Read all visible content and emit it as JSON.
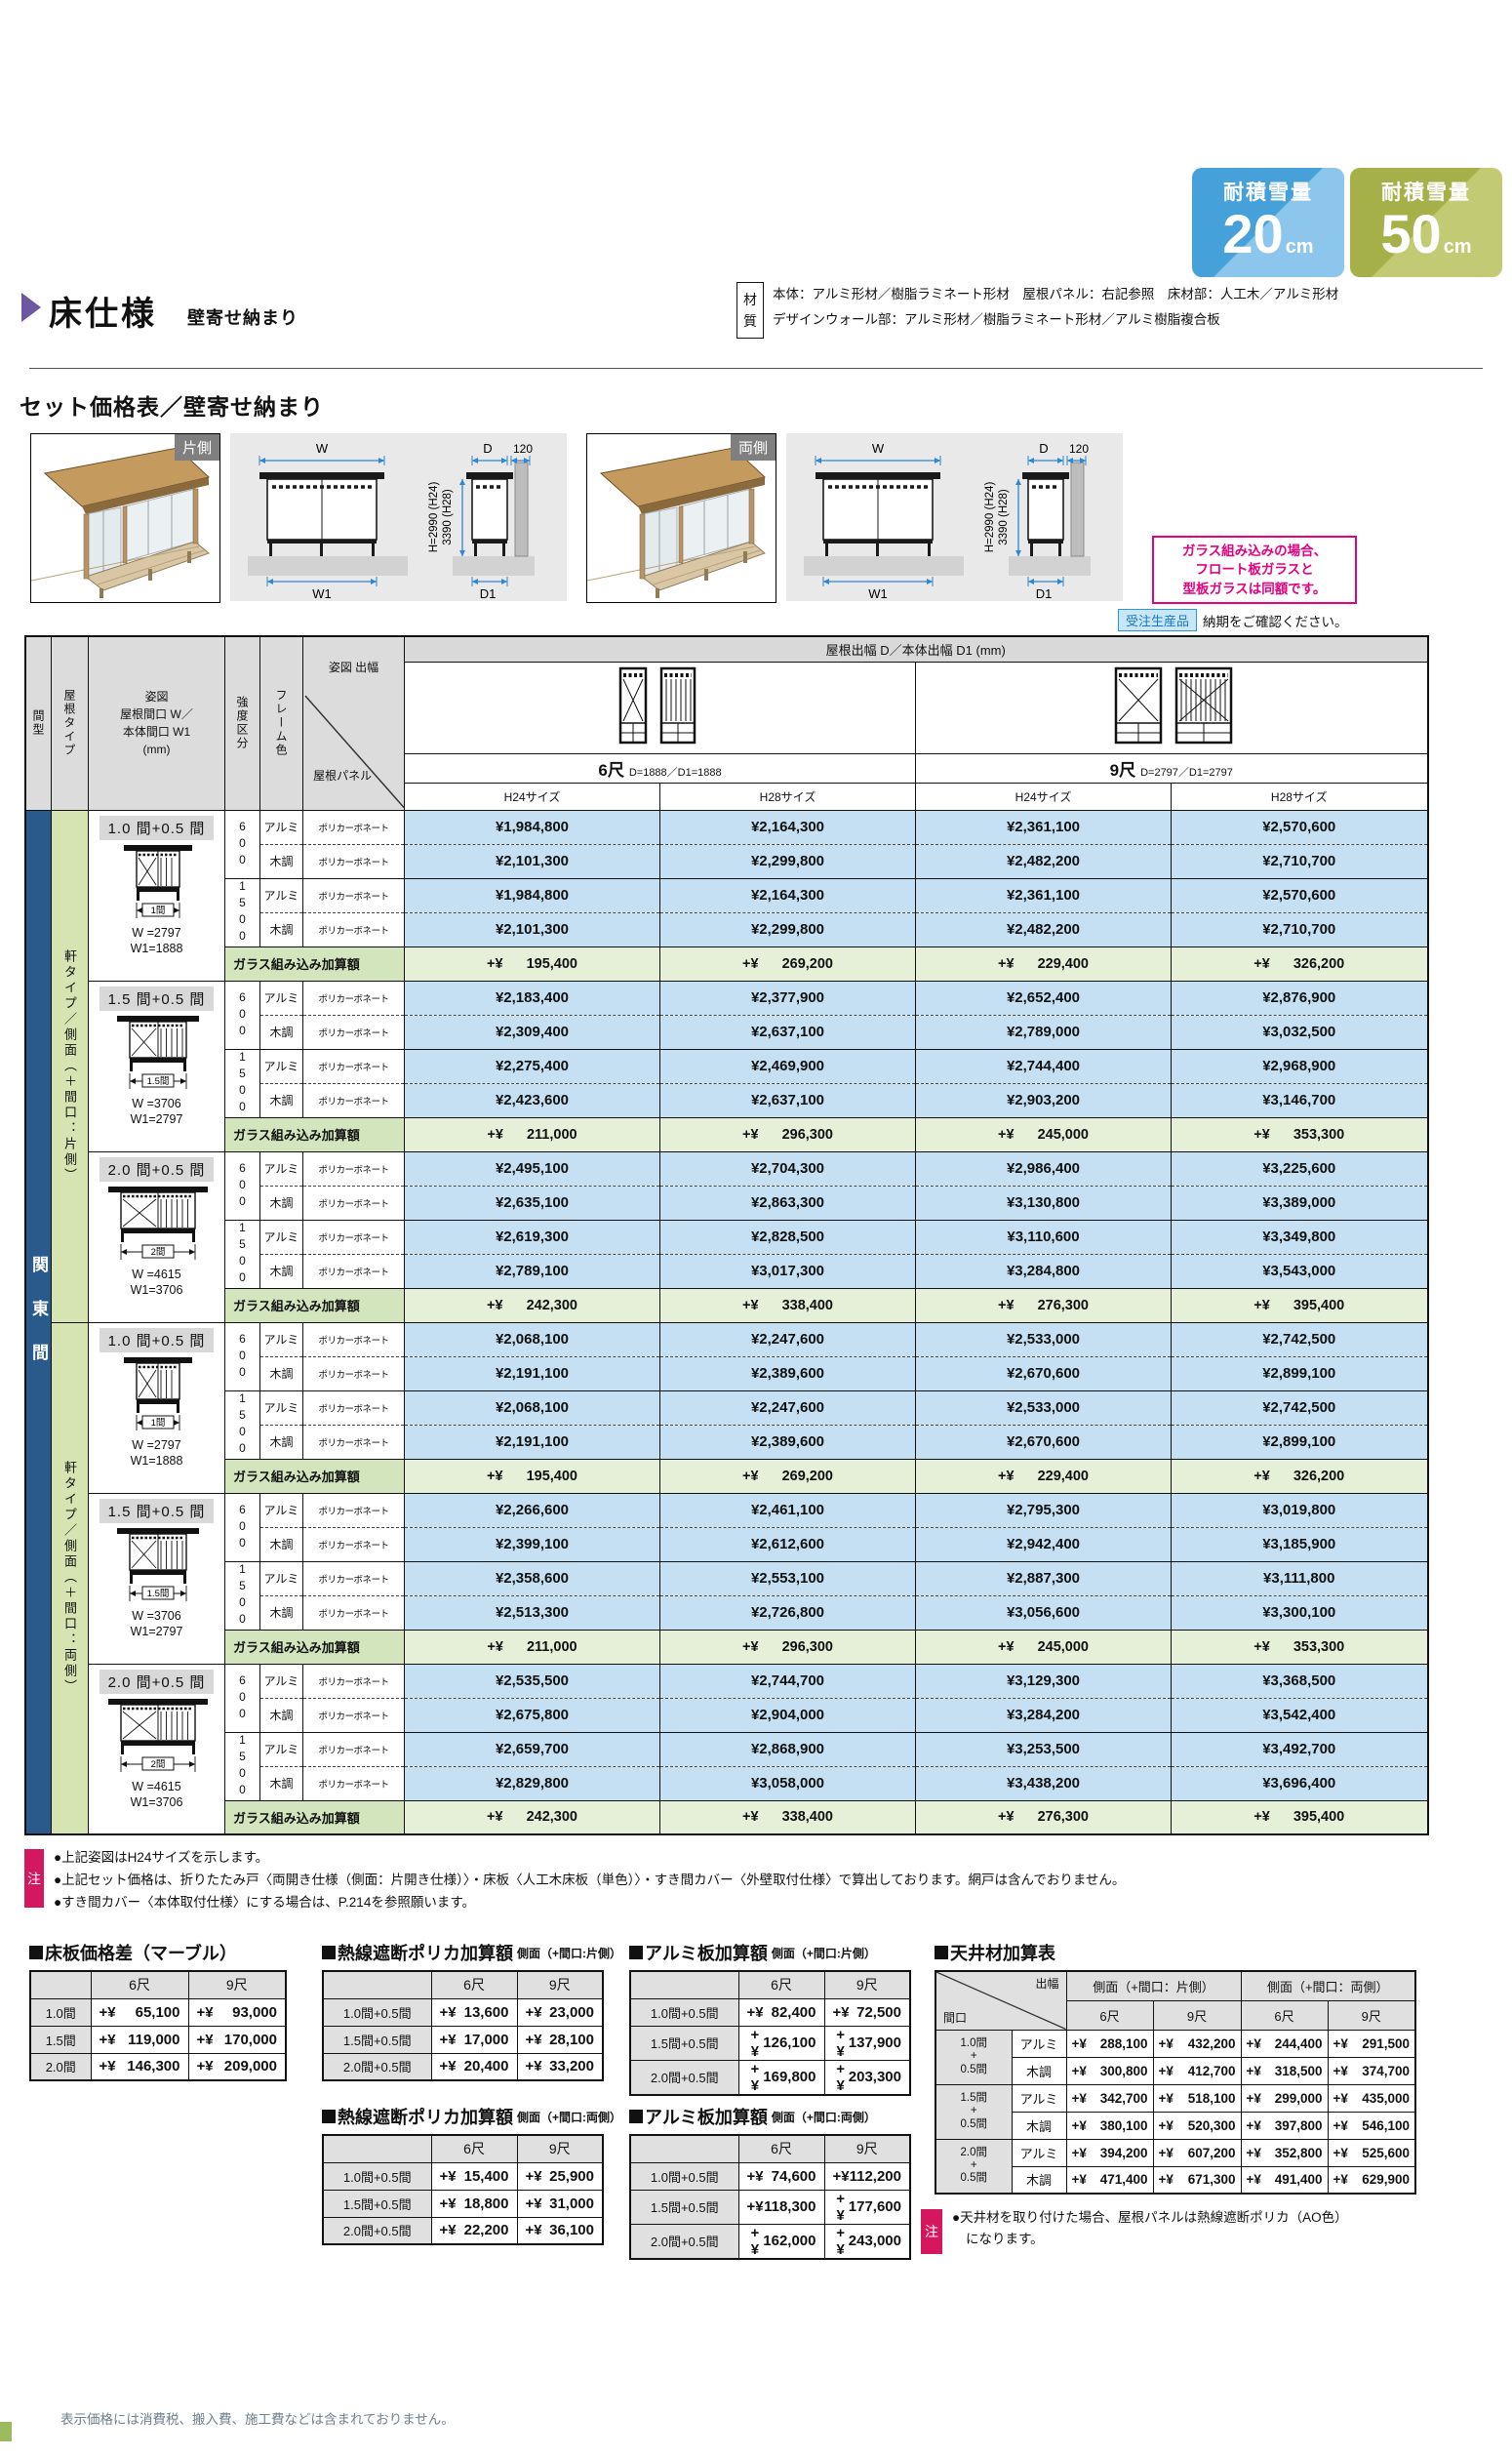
{
  "colors": {
    "pink": "#e4007f",
    "navy": "#2a598c",
    "green": "#d5e4b0",
    "blue": "#c4e0f2",
    "glass_label": "#d3e5bd",
    "glass_value": "#e6f0d9",
    "red": "#d4175e",
    "order_bg": "#c7e6f7",
    "order_border": "#2f96d3",
    "order_text": "#1878bc",
    "purple": "#6c57a0"
  },
  "badges": [
    {
      "label": "耐積雪量",
      "value": "20",
      "unit": "cm",
      "c1": "#46a0da",
      "c2": "#8cc6ec"
    },
    {
      "label": "耐積雪量",
      "value": "50",
      "unit": "cm",
      "c1": "#a6b049",
      "c2": "#c2ca73"
    }
  ],
  "header": {
    "title": "床仕様",
    "subtitle": "壁寄せ納まり",
    "material_chars": [
      "材",
      "質"
    ],
    "material_lines": [
      "本体：アルミ形材／樹脂ラミネート形材　屋根パネル：右記参照　床材部：人工木／アルミ形材",
      "デザインウォール部：アルミ形材／樹脂ラミネート形材／アルミ樹脂複合板"
    ]
  },
  "section": {
    "title": "セット価格表／壁寄せ納まり",
    "photos": [
      {
        "label": "片側"
      },
      {
        "label": "両側"
      }
    ],
    "tech": {
      "w": "W",
      "w1": "W1",
      "d": "D",
      "gap": "120",
      "d1": "D1",
      "h1": "H=2990 (H24)",
      "h2": "3390 (H28)"
    },
    "pink_note": [
      "ガラス組み込みの場合、",
      "フロート板ガラスと",
      "型板ガラスは同額です。"
    ],
    "order": {
      "badge": "受注生産品",
      "text": "納期をご確認ください。"
    }
  },
  "plus_prefix": "+¥",
  "main_table": {
    "kanto": "関東間",
    "panel_label": "ポリカーボネート",
    "glass_label": "ガラス組み込み加算額",
    "col_h": {
      "madori": "間型",
      "roof": "屋根タイプ",
      "sugata": [
        "姿図",
        "屋根間口 W／",
        "本体間口 W1",
        "(mm)"
      ],
      "kyodo": "強度区分",
      "frame": "フレーム色",
      "debuta": "姿図 出幅",
      "panel": "屋根パネル",
      "span": "屋根出幅 D／本体出幅 D1 (mm)",
      "h24": "H24サイズ",
      "h28": "H28サイズ"
    },
    "sizes": [
      {
        "feet": "6尺",
        "note": "D=1888／D1=1888"
      },
      {
        "feet": "9尺",
        "note": "D=2797／D1=2797"
      }
    ],
    "groups": [
      {
        "side_label": "軒タイプ／側面（＋間口：片側）",
        "blocks": [
          {
            "title": "1.0 間+0.5 間",
            "dim": "1間",
            "w": "W =2797",
            "w1": "W1=1888",
            "rows": [
              {
                "kyodo": "600",
                "frame": "アルミ",
                "prices": [
                  "¥1,984,800",
                  "¥2,164,300",
                  "¥2,361,100",
                  "¥2,570,600"
                ]
              },
              {
                "frame": "木調",
                "prices": [
                  "¥2,101,300",
                  "¥2,299,800",
                  "¥2,482,200",
                  "¥2,710,700"
                ]
              },
              {
                "kyodo": "1500",
                "frame": "アルミ",
                "prices": [
                  "¥1,984,800",
                  "¥2,164,300",
                  "¥2,361,100",
                  "¥2,570,600"
                ]
              },
              {
                "frame": "木調",
                "prices": [
                  "¥2,101,300",
                  "¥2,299,800",
                  "¥2,482,200",
                  "¥2,710,700"
                ]
              }
            ],
            "glass": [
              "195,400",
              "269,200",
              "229,400",
              "326,200"
            ]
          },
          {
            "title": "1.5 間+0.5 間",
            "dim": "1.5間",
            "w": "W =3706",
            "w1": "W1=2797",
            "rows": [
              {
                "kyodo": "600",
                "frame": "アルミ",
                "prices": [
                  "¥2,183,400",
                  "¥2,377,900",
                  "¥2,652,400",
                  "¥2,876,900"
                ]
              },
              {
                "frame": "木調",
                "prices": [
                  "¥2,309,400",
                  "¥2,637,100",
                  "¥2,789,000",
                  "¥3,032,500"
                ]
              },
              {
                "kyodo": "1500",
                "frame": "アルミ",
                "prices": [
                  "¥2,275,400",
                  "¥2,469,900",
                  "¥2,744,400",
                  "¥2,968,900"
                ]
              },
              {
                "frame": "木調",
                "prices": [
                  "¥2,423,600",
                  "¥2,637,100",
                  "¥2,903,200",
                  "¥3,146,700"
                ]
              }
            ],
            "glass": [
              "211,000",
              "296,300",
              "245,000",
              "353,300"
            ]
          },
          {
            "title": "2.0 間+0.5 間",
            "dim": "2間",
            "w": "W =4615",
            "w1": "W1=3706",
            "rows": [
              {
                "kyodo": "600",
                "frame": "アルミ",
                "prices": [
                  "¥2,495,100",
                  "¥2,704,300",
                  "¥2,986,400",
                  "¥3,225,600"
                ]
              },
              {
                "frame": "木調",
                "prices": [
                  "¥2,635,100",
                  "¥2,863,300",
                  "¥3,130,800",
                  "¥3,389,000"
                ]
              },
              {
                "kyodo": "1500",
                "frame": "アルミ",
                "prices": [
                  "¥2,619,300",
                  "¥2,828,500",
                  "¥3,110,600",
                  "¥3,349,800"
                ]
              },
              {
                "frame": "木調",
                "prices": [
                  "¥2,789,100",
                  "¥3,017,300",
                  "¥3,284,800",
                  "¥3,543,000"
                ]
              }
            ],
            "glass": [
              "242,300",
              "338,400",
              "276,300",
              "395,400"
            ]
          }
        ]
      },
      {
        "side_label": "軒タイプ／側面（＋間口：両側）",
        "blocks": [
          {
            "title": "1.0 間+0.5 間",
            "dim": "1間",
            "w": "W =2797",
            "w1": "W1=1888",
            "rows": [
              {
                "kyodo": "600",
                "frame": "アルミ",
                "prices": [
                  "¥2,068,100",
                  "¥2,247,600",
                  "¥2,533,000",
                  "¥2,742,500"
                ]
              },
              {
                "frame": "木調",
                "prices": [
                  "¥2,191,100",
                  "¥2,389,600",
                  "¥2,670,600",
                  "¥2,899,100"
                ]
              },
              {
                "kyodo": "1500",
                "frame": "アルミ",
                "prices": [
                  "¥2,068,100",
                  "¥2,247,600",
                  "¥2,533,000",
                  "¥2,742,500"
                ]
              },
              {
                "frame": "木調",
                "prices": [
                  "¥2,191,100",
                  "¥2,389,600",
                  "¥2,670,600",
                  "¥2,899,100"
                ]
              }
            ],
            "glass": [
              "195,400",
              "269,200",
              "229,400",
              "326,200"
            ]
          },
          {
            "title": "1.5 間+0.5 間",
            "dim": "1.5間",
            "w": "W =3706",
            "w1": "W1=2797",
            "rows": [
              {
                "kyodo": "600",
                "frame": "アルミ",
                "prices": [
                  "¥2,266,600",
                  "¥2,461,100",
                  "¥2,795,300",
                  "¥3,019,800"
                ]
              },
              {
                "frame": "木調",
                "prices": [
                  "¥2,399,100",
                  "¥2,612,600",
                  "¥2,942,400",
                  "¥3,185,900"
                ]
              },
              {
                "kyodo": "1500",
                "frame": "アルミ",
                "prices": [
                  "¥2,358,600",
                  "¥2,553,100",
                  "¥2,887,300",
                  "¥3,111,800"
                ]
              },
              {
                "frame": "木調",
                "prices": [
                  "¥2,513,300",
                  "¥2,726,800",
                  "¥3,056,600",
                  "¥3,300,100"
                ]
              }
            ],
            "glass": [
              "211,000",
              "296,300",
              "245,000",
              "353,300"
            ]
          },
          {
            "title": "2.0 間+0.5 間",
            "dim": "2間",
            "w": "W =4615",
            "w1": "W1=3706",
            "rows": [
              {
                "kyodo": "600",
                "frame": "アルミ",
                "prices": [
                  "¥2,535,500",
                  "¥2,744,700",
                  "¥3,129,300",
                  "¥3,368,500"
                ]
              },
              {
                "frame": "木調",
                "prices": [
                  "¥2,675,800",
                  "¥2,904,000",
                  "¥3,284,200",
                  "¥3,542,400"
                ]
              },
              {
                "kyodo": "1500",
                "frame": "アルミ",
                "prices": [
                  "¥2,659,700",
                  "¥2,868,900",
                  "¥3,253,500",
                  "¥3,492,700"
                ]
              },
              {
                "frame": "木調",
                "prices": [
                  "¥2,829,800",
                  "¥3,058,000",
                  "¥3,438,200",
                  "¥3,696,400"
                ]
              }
            ],
            "glass": [
              "242,300",
              "338,400",
              "276,300",
              "395,400"
            ]
          }
        ]
      }
    ]
  },
  "notes": {
    "badge": "注",
    "items": [
      "●上記姿図はH24サイズを示します。",
      "●上記セット価格は、折りたたみ戸〈両開き仕様（側面：片開き仕様）〉・床板〈人工木床板（単色）〉・すき間カバー〈外壁取付仕様〉で算出しております。網戸は含んでおりません。",
      "●すき間カバー〈本体取付仕様〉にする場合は、P.214を参照願います。"
    ]
  },
  "sub_tables": [
    {
      "title": "床板価格差（マーブル）",
      "subtitle": "",
      "col_headers": [
        "6尺",
        "9尺"
      ],
      "rows": [
        [
          "1.0間",
          "65,100",
          "93,000"
        ],
        [
          "1.5間",
          "119,000",
          "170,000"
        ],
        [
          "2.0間",
          "146,300",
          "209,000"
        ]
      ]
    },
    {
      "title": "熱線遮断ポリカ加算額",
      "subtitle": "側面（+間口:片側）",
      "col_headers": [
        "6尺",
        "9尺"
      ],
      "rows": [
        [
          "1.0間+0.5間",
          "13,600",
          "23,000"
        ],
        [
          "1.5間+0.5間",
          "17,000",
          "28,100"
        ],
        [
          "2.0間+0.5間",
          "20,400",
          "33,200"
        ]
      ]
    },
    {
      "title": "熱線遮断ポリカ加算額",
      "subtitle": "側面（+間口:両側）",
      "col_headers": [
        "6尺",
        "9尺"
      ],
      "rows": [
        [
          "1.0間+0.5間",
          "15,400",
          "25,900"
        ],
        [
          "1.5間+0.5間",
          "18,800",
          "31,000"
        ],
        [
          "2.0間+0.5間",
          "22,200",
          "36,100"
        ]
      ]
    },
    {
      "title": "アルミ板加算額",
      "subtitle": "側面（+間口:片側）",
      "col_headers": [
        "6尺",
        "9尺"
      ],
      "rows": [
        [
          "1.0間+0.5間",
          "82,400",
          "72,500"
        ],
        [
          "1.5間+0.5間",
          "126,100",
          "137,900"
        ],
        [
          "2.0間+0.5間",
          "169,800",
          "203,300"
        ]
      ]
    },
    {
      "title": "アルミ板加算額",
      "subtitle": "側面（+間口:両側）",
      "col_headers": [
        "6尺",
        "9尺"
      ],
      "rows": [
        [
          "1.0間+0.5間",
          "74,600",
          "112,200"
        ],
        [
          "1.5間+0.5間",
          "118,300",
          "177,600"
        ],
        [
          "2.0間+0.5間",
          "162,000",
          "243,000"
        ]
      ]
    }
  ],
  "ceiling_table": {
    "title": "天井材加算表",
    "corner": {
      "top": "出幅",
      "bottom": "間口"
    },
    "groups": [
      "側面（+間口：片側）",
      "側面（+間口：両側）"
    ],
    "sizes": [
      "6尺",
      "9尺",
      "6尺",
      "9尺"
    ],
    "rows": [
      {
        "label_lines": [
          "1.0間",
          "+",
          "0.5間"
        ],
        "materials": [
          {
            "name": "アルミ",
            "values": [
              "288,100",
              "432,200",
              "244,400",
              "291,500"
            ]
          },
          {
            "name": "木調",
            "values": [
              "300,800",
              "412,700",
              "318,500",
              "374,700"
            ]
          }
        ]
      },
      {
        "label_lines": [
          "1.5間",
          "+",
          "0.5間"
        ],
        "materials": [
          {
            "name": "アルミ",
            "values": [
              "342,700",
              "518,100",
              "299,000",
              "435,000"
            ]
          },
          {
            "name": "木調",
            "values": [
              "380,100",
              "520,300",
              "397,800",
              "546,100"
            ]
          }
        ]
      },
      {
        "label_lines": [
          "2.0間",
          "+",
          "0.5間"
        ],
        "materials": [
          {
            "name": "アルミ",
            "values": [
              "394,200",
              "607,200",
              "352,800",
              "525,600"
            ]
          },
          {
            "name": "木調",
            "values": [
              "471,400",
              "671,300",
              "491,400",
              "629,900"
            ]
          }
        ]
      }
    ],
    "note_badge": "注",
    "note_lines": [
      "●天井材を取り付けた場合、屋根パネルは熱線遮断ポリカ（AO色）",
      "になります。"
    ]
  },
  "footer": "表示価格には消費税、搬入費、施工費などは含まれておりません。"
}
